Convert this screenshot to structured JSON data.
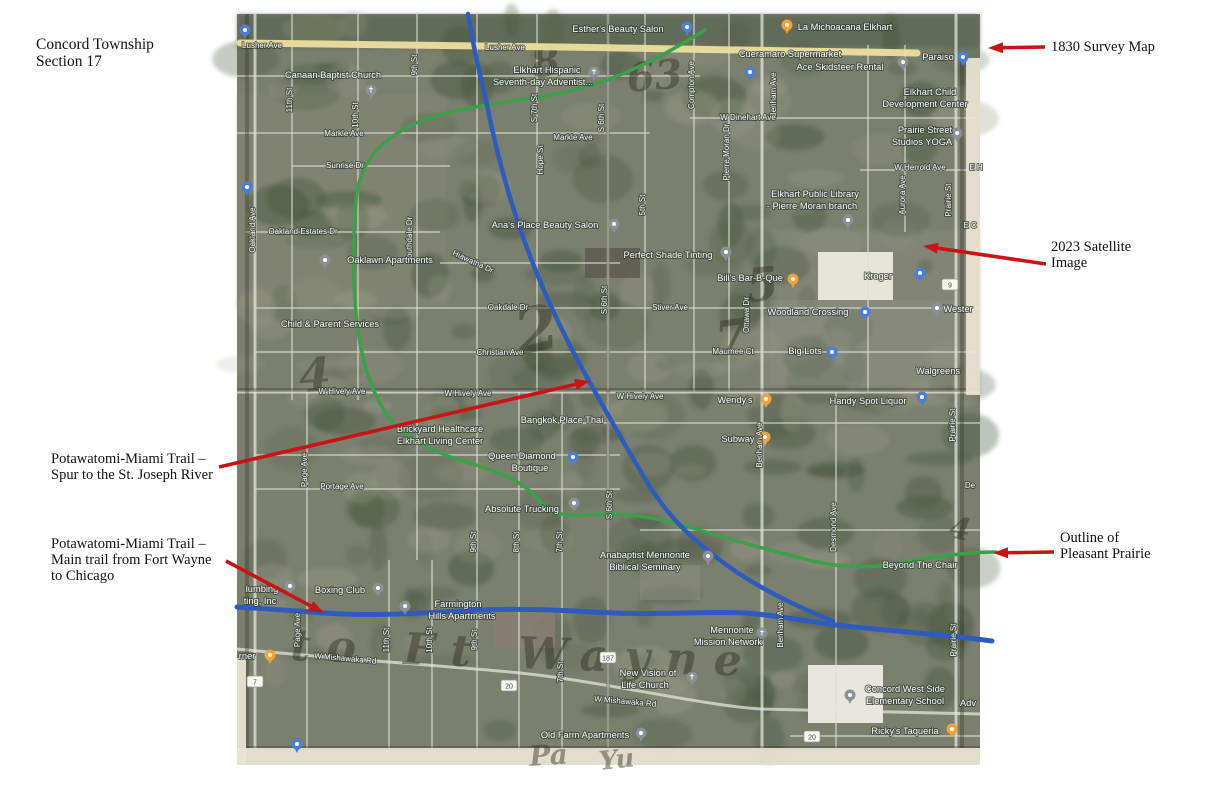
{
  "title": {
    "lines": [
      "Concord Township",
      "Section 17"
    ]
  },
  "annotations": {
    "arrow_color": "#c81414",
    "survey": {
      "lines": [
        "1830 Survey Map"
      ]
    },
    "satellite": {
      "lines": [
        "2023 Satellite",
        "Image"
      ]
    },
    "spur": {
      "lines": [
        "Potawatomi-Miami Trail –",
        "Spur to the St. Joseph River"
      ]
    },
    "main_trail": {
      "lines": [
        "Potawatomi-Miami Trail –",
        "Main trail from Fort Wayne",
        "to Chicago"
      ]
    },
    "prairie": {
      "lines": [
        "Outline of",
        "Pleasant Prairie"
      ]
    },
    "arrows": [
      {
        "name": "survey-arrow",
        "x1": 1045,
        "y1": 47,
        "x2": 988,
        "y2": 48
      },
      {
        "name": "satellite-arrow",
        "x1": 1046,
        "y1": 264,
        "x2": 923,
        "y2": 246
      },
      {
        "name": "spur-arrow",
        "x1": 219,
        "y1": 467,
        "x2": 590,
        "y2": 381
      },
      {
        "name": "main-trail-arrow",
        "x1": 226,
        "y1": 561,
        "x2": 324,
        "y2": 613
      },
      {
        "name": "prairie-arrow",
        "x1": 1054,
        "y1": 552,
        "x2": 993,
        "y2": 553
      }
    ]
  },
  "map": {
    "colors": {
      "base": "#7b7f6e",
      "tree": "#46543a",
      "light": "#a5a58d",
      "road": "rgba(222,222,212,0.55)",
      "road_major": "rgba(232,232,224,0.72)",
      "survey_ink": "rgba(45,40,25,0.30)",
      "paper": "#eae5d4",
      "yellow_road": "#ecdf9e",
      "trail_blue": "#2e5cbe",
      "trail_green": "#3aa04a",
      "label_fill": "#ffffff",
      "label_stroke": "rgba(50,58,48,0.75)",
      "hand_ink": "#32301f",
      "pin_blue": "#4a7fd4",
      "pin_gray": "#8a9096",
      "pin_yellow": "#f0a23c"
    },
    "trails": {
      "lusher": "M240,43 L560,47 L917,53",
      "spur": "M468,14 C473,45 480,75 487,105 C496,150 508,195 523,237 C540,285 562,333 589,381 C607,413 626,448 652,490 C674,524 703,549 738,573 C772,595 803,609 833,621",
      "main": "M237,607 C270,609 298,611 324,613 C380,617 430,612 480,610 C530,608 570,611 615,613 C660,615 705,611 745,613 C785,616 815,623 845,626 C890,631 940,634 992,641",
      "prairie": "M705,30 C665,55 610,86 545,96 C495,104 440,110 410,126 C378,142 359,165 356,200 C353,240 352,282 357,322 C361,357 369,387 386,413 C401,436 432,452 466,462 C500,472 522,481 537,498 C550,513 563,517 587,515 C622,512 652,516 692,528 C732,540 772,551 812,561 C852,570 882,567 912,561 C942,556 968,552 996,552",
      "mishawaka": "M237,649 C350,660 450,666 520,673 C600,681 700,705 760,709 L980,714"
    },
    "survey_lines": [
      [
        608,
        14,
        608,
        748
      ],
      [
        237,
        390,
        980,
        390
      ],
      [
        247,
        14,
        247,
        748
      ],
      [
        962,
        55,
        962,
        748
      ],
      [
        237,
        748,
        980,
        748
      ]
    ],
    "paper_patches": [
      [
        966,
        58,
        14,
        337
      ],
      [
        237,
        748,
        743,
        17
      ],
      [
        237,
        658,
        9,
        107
      ]
    ],
    "v_roads": [
      [
        255,
        14,
        748,
        3
      ],
      [
        292,
        14,
        400,
        2
      ],
      [
        307,
        392,
        748,
        2
      ],
      [
        358,
        14,
        400,
        2
      ],
      [
        389,
        560,
        748,
        2
      ],
      [
        417,
        14,
        560,
        2
      ],
      [
        432,
        560,
        748,
        2
      ],
      [
        477,
        14,
        748,
        2
      ],
      [
        519,
        392,
        748,
        2
      ],
      [
        537,
        14,
        392,
        2
      ],
      [
        562,
        392,
        748,
        2
      ],
      [
        608,
        14,
        748,
        3
      ],
      [
        645,
        14,
        392,
        2
      ],
      [
        694,
        14,
        392,
        2
      ],
      [
        729,
        14,
        392,
        2
      ],
      [
        762,
        14,
        748,
        3
      ],
      [
        836,
        392,
        748,
        2
      ],
      [
        868,
        45,
        392,
        2
      ],
      [
        905,
        45,
        232,
        2
      ],
      [
        956,
        14,
        748,
        3
      ]
    ],
    "h_roads": [
      [
        76,
        237,
        700,
        2
      ],
      [
        118,
        690,
        980,
        2
      ],
      [
        133,
        237,
        650,
        2
      ],
      [
        166,
        292,
        450,
        2
      ],
      [
        170,
        860,
        980,
        2
      ],
      [
        232,
        245,
        440,
        2
      ],
      [
        263,
        440,
        620,
        2
      ],
      [
        308,
        255,
        980,
        2
      ],
      [
        352,
        255,
        980,
        2
      ],
      [
        392,
        237,
        980,
        3
      ],
      [
        423,
        530,
        980,
        2
      ],
      [
        455,
        255,
        620,
        2
      ],
      [
        489,
        255,
        620,
        2
      ],
      [
        530,
        640,
        980,
        2
      ],
      [
        736,
        790,
        980,
        2
      ]
    ],
    "buildings": [
      [
        818,
        252,
        75,
        48,
        "#ece9e2",
        0.95
      ],
      [
        770,
        300,
        185,
        85,
        "#8f9086",
        0.45
      ],
      [
        808,
        665,
        75,
        58,
        "#efece6",
        0.95
      ],
      [
        495,
        608,
        60,
        40,
        "#8a7f72",
        0.8
      ],
      [
        585,
        248,
        55,
        30,
        "#5d594e",
        0.8
      ],
      [
        640,
        565,
        60,
        35,
        "#8f9086",
        0.5
      ]
    ],
    "street_labels": [
      [
        "Lusher Ave",
        262,
        48,
        0
      ],
      [
        "Lusher Ave",
        505,
        50,
        0
      ],
      [
        "Oakland Ave",
        255,
        230,
        "v"
      ],
      [
        "11th St",
        292,
        100,
        "v"
      ],
      [
        "10th St",
        358,
        115,
        "v"
      ],
      [
        "9th St",
        417,
        65,
        "v"
      ],
      [
        "Markle Ave",
        344,
        136,
        0
      ],
      [
        "Markle Ave",
        573,
        140,
        0
      ],
      [
        "Sunrise Dr",
        345,
        168,
        0
      ],
      [
        "Oakland Estates Dr",
        303,
        234,
        0
      ],
      [
        "Southdale Dr",
        412,
        240,
        "v"
      ],
      [
        "Hiawatha Dr",
        472,
        264,
        25
      ],
      [
        "Oakdale Dr",
        508,
        310,
        0
      ],
      [
        "Christian Ave",
        500,
        355,
        0
      ],
      [
        "S 7th St",
        537,
        108,
        "v"
      ],
      [
        "Hope St",
        543,
        160,
        "v"
      ],
      [
        "S 6th St",
        604,
        118,
        "v"
      ],
      [
        "S 6th St",
        607,
        300,
        "v"
      ],
      [
        "S 6th St",
        612,
        505,
        "v"
      ],
      [
        "5th St",
        645,
        205,
        "v"
      ],
      [
        "Compton Ave",
        694,
        85,
        "v"
      ],
      [
        "Pierre Moran Dr",
        729,
        152,
        "v"
      ],
      [
        "Benham Ave",
        776,
        95,
        "v"
      ],
      [
        "Benham Ave",
        762,
        445,
        "v"
      ],
      [
        "Benham Ave",
        783,
        625,
        "v"
      ],
      [
        "Aurora Ave",
        905,
        195,
        "v"
      ],
      [
        "Prairie St",
        951,
        200,
        "v"
      ],
      [
        "Prairie St",
        955,
        425,
        "v"
      ],
      [
        "Prairie St",
        956,
        640,
        "v"
      ],
      [
        "W Dinehart Ave",
        748,
        120,
        0
      ],
      [
        "W Herrold Ave",
        920,
        170,
        0
      ],
      [
        "E H",
        976,
        170,
        0
      ],
      [
        "E C",
        970,
        228,
        0
      ],
      [
        "De",
        970,
        488,
        0
      ],
      [
        "Stiver Ave",
        670,
        310,
        0
      ],
      [
        "Maumee Ct",
        733,
        354,
        0
      ],
      [
        "Ottawa Dr",
        749,
        315,
        "v"
      ],
      [
        "Desmond Ave",
        836,
        527,
        "v"
      ],
      [
        "W Hively Ave",
        342,
        394,
        0
      ],
      [
        "W Hively Ave",
        468,
        396,
        0
      ],
      [
        "W Hively Ave",
        640,
        399,
        0
      ],
      [
        "Page Ave",
        307,
        470,
        "v"
      ],
      [
        "Page Ave",
        300,
        630,
        "v"
      ],
      [
        "Portage Ave",
        342,
        489,
        0
      ],
      [
        "9th St",
        476,
        542,
        "v"
      ],
      [
        "8th St",
        519,
        542,
        "v"
      ],
      [
        "7th St",
        562,
        542,
        "v"
      ],
      [
        "7th St",
        563,
        672,
        "v"
      ],
      [
        "11th St",
        389,
        640,
        "v"
      ],
      [
        "10th St",
        432,
        640,
        "v"
      ],
      [
        "9th St",
        477,
        640,
        "v"
      ],
      [
        "W Mishawaka Rd",
        345,
        661,
        5
      ],
      [
        "W Mishawaka Rd",
        625,
        704,
        5
      ]
    ],
    "poi_labels": [
      [
        "Esther's Beauty Salon",
        618,
        32
      ],
      [
        "La Michoacana Elkhart",
        845,
        30
      ],
      [
        "Cueramaro Supermarket",
        790,
        57
      ],
      [
        "Ace Skidsteer Rental",
        840,
        70
      ],
      [
        "Paraiso",
        938,
        60
      ],
      [
        "Canaan Baptist Church",
        333,
        78
      ],
      [
        "Elkhart Hispanic",
        547,
        73
      ],
      [
        "Seventh-day Adventist...",
        543,
        85
      ],
      [
        "Elkhart Child",
        930,
        95
      ],
      [
        "Development Center",
        925,
        107
      ],
      [
        "Prairie Street",
        925,
        133
      ],
      [
        "Studios YOGA",
        922,
        145
      ],
      [
        "Elkhart Public Library",
        815,
        197
      ],
      [
        "- Pierre Moran branch",
        812,
        209
      ],
      [
        "Ana's Place Beauty Salon",
        545,
        228
      ],
      [
        "Oaklawn Apartments",
        390,
        263
      ],
      [
        "Perfect Shade Tinting",
        668,
        258
      ],
      [
        "Bill's Bar-B-Que",
        750,
        281
      ],
      [
        "Kroger",
        878,
        279
      ],
      [
        "Child & Parent Services",
        330,
        327
      ],
      [
        "Woodland Crossing",
        808,
        315
      ],
      [
        "Big Lots",
        805,
        354
      ],
      [
        "Walgreens",
        938,
        374
      ],
      [
        "Wester",
        958,
        312
      ],
      [
        "Wendy's",
        735,
        403
      ],
      [
        "Subway",
        738,
        442
      ],
      [
        "Handy Spot Liquor",
        868,
        404
      ],
      [
        "Bangkok Place Thai",
        562,
        423
      ],
      [
        "Brickyard Healthcare",
        440,
        432
      ],
      [
        "Elkhart Living Center",
        440,
        444
      ],
      [
        "Queen Diamond",
        522,
        459
      ],
      [
        "Boutique",
        530,
        471
      ],
      [
        "Absolute Trucking",
        522,
        512
      ],
      [
        "Anabaptist Mennonite",
        645,
        558
      ],
      [
        "Biblical Seminary",
        645,
        570
      ],
      [
        "Beyond The Chair",
        920,
        568
      ],
      [
        "Boxing Club",
        340,
        593
      ],
      [
        "lumbing",
        262,
        592
      ],
      [
        "ting, Inc",
        260,
        604
      ],
      [
        "Farmington",
        458,
        607
      ],
      [
        "Hills Apartments",
        462,
        619
      ],
      [
        "rner",
        247,
        659
      ],
      [
        "Mennonite",
        732,
        633
      ],
      [
        "Mission Network",
        728,
        645
      ],
      [
        "New Vision of",
        648,
        676
      ],
      [
        "Life Church",
        645,
        688
      ],
      [
        "Old Farm Apartments",
        585,
        738
      ],
      [
        "Concord West Side",
        905,
        692
      ],
      [
        "Elementary School",
        905,
        704
      ],
      [
        "Adv",
        968,
        706
      ],
      [
        "Ricky's Taqueria",
        905,
        734
      ]
    ],
    "pins": [
      [
        "blue",
        245,
        30
      ],
      [
        "blue",
        687,
        27
      ],
      [
        "yellow",
        787,
        25
      ],
      [
        "blue",
        750,
        72
      ],
      [
        "gray",
        903,
        62
      ],
      [
        "blue",
        963,
        57
      ],
      [
        "church",
        371,
        90
      ],
      [
        "church",
        594,
        72
      ],
      [
        "gray",
        957,
        133
      ],
      [
        "gray",
        848,
        220
      ],
      [
        "gray",
        614,
        224
      ],
      [
        "gray",
        726,
        252
      ],
      [
        "gray",
        325,
        260
      ],
      [
        "yellow",
        793,
        279
      ],
      [
        "blue",
        920,
        273
      ],
      [
        "blue",
        865,
        312
      ],
      [
        "blue",
        832,
        352
      ],
      [
        "gray",
        937,
        308
      ],
      [
        "yellow",
        766,
        399
      ],
      [
        "yellow",
        765,
        437
      ],
      [
        "blue",
        922,
        397
      ],
      [
        "blue",
        573,
        457
      ],
      [
        "gray",
        574,
        503
      ],
      [
        "gray",
        708,
        556
      ],
      [
        "gray",
        378,
        588
      ],
      [
        "gray",
        290,
        586
      ],
      [
        "gray",
        405,
        606
      ],
      [
        "yellow",
        270,
        655
      ],
      [
        "church",
        762,
        633
      ],
      [
        "church",
        692,
        677
      ],
      [
        "gray",
        641,
        733
      ],
      [
        "school",
        850,
        695
      ],
      [
        "yellow",
        952,
        729
      ],
      [
        "blue",
        247,
        187
      ],
      [
        "blue",
        297,
        744
      ]
    ],
    "shields": [
      [
        "20",
        509,
        686
      ],
      [
        "20",
        812,
        737
      ],
      [
        "187",
        608,
        658
      ],
      [
        "9",
        950,
        285
      ],
      [
        "7",
        255,
        682
      ]
    ],
    "handwriting": [
      [
        "8",
        533,
        78,
        42,
        -8,
        0
      ],
      [
        "63",
        628,
        92,
        40,
        -5,
        0
      ],
      [
        "2",
        520,
        355,
        62,
        -12,
        0
      ],
      [
        "7",
        718,
        355,
        46,
        -8,
        0
      ],
      [
        "5",
        748,
        302,
        46,
        -6,
        0
      ],
      [
        "4",
        300,
        392,
        46,
        -4,
        0
      ],
      [
        "4",
        948,
        537,
        30,
        10,
        0
      ],
      [
        "to Ft Wayne",
        290,
        660,
        44,
        2,
        16
      ],
      [
        "Pa",
        530,
        766,
        28,
        -4,
        0
      ],
      [
        "Yu",
        600,
        770,
        26,
        -6,
        0
      ]
    ]
  }
}
